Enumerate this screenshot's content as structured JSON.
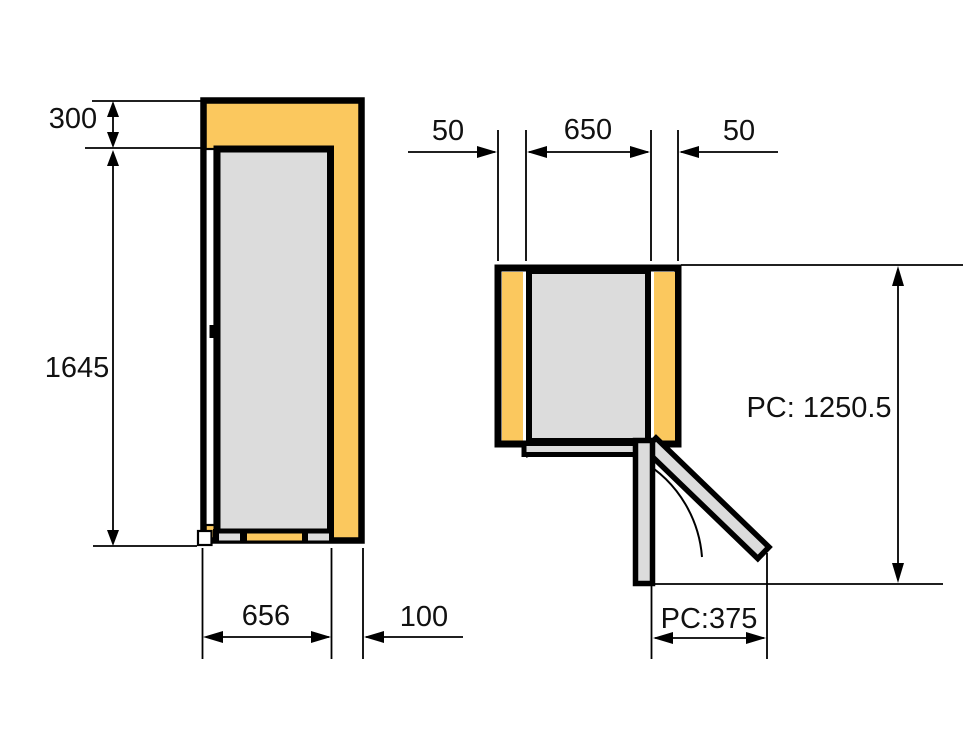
{
  "colors": {
    "clearance": "#FBC85E",
    "appliance": "#DCDCDC",
    "door_fill": "#DCDCDC",
    "outline": "#000000",
    "background": "#FFFFFF"
  },
  "side_view": {
    "top_clearance": "300",
    "height": "1645",
    "depth": "656",
    "rear_clearance": "100"
  },
  "top_view": {
    "left_clearance": "50",
    "width": "650",
    "right_clearance": "50",
    "depth_with_open_door": "PC: 1250.5",
    "door_projection": "PC:375"
  }
}
